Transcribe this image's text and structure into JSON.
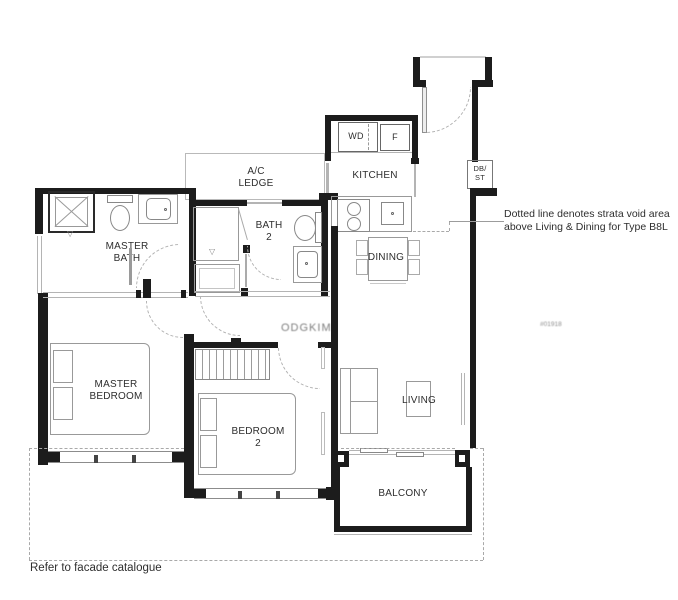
{
  "plan": {
    "rooms": {
      "master_bath": "MASTER\nBATH",
      "bath_2": "BATH\n2",
      "ac_ledge": "A/C\nLEDGE",
      "kitchen": "KITCHEN",
      "dining": "DINING",
      "master_bedroom": "MASTER\nBEDROOM",
      "bedroom_2": "BEDROOM\n2",
      "living": "LIVING",
      "balcony": "BALCONY"
    },
    "appliances": {
      "washer_dryer": "WD",
      "fridge": "F",
      "db_store": "DB/\nST"
    },
    "annotation": "Dotted line denotes strata void area\nabove Living & Dining for Type B8L",
    "footer_note": "Refer to facade catalogue",
    "watermark_center": "ODGKIM",
    "watermark_right": "#01918",
    "colors": {
      "wall": "#1c1c1c",
      "fixture": "#9a9a9a",
      "dashed": "#a9a9a9",
      "text": "#2e2e2e"
    }
  }
}
